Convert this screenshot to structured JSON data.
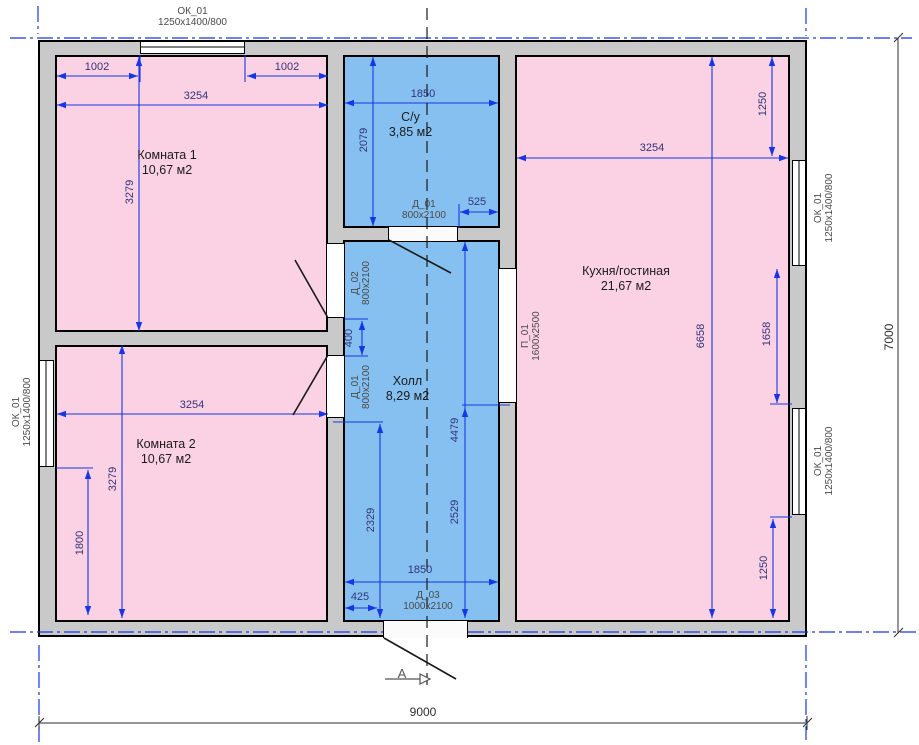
{
  "title": "План этажа",
  "rooms": {
    "room1": {
      "name": "Комната 1",
      "area": "10,67 м2"
    },
    "room2": {
      "name": "Комната 2",
      "area": "10,67 м2"
    },
    "wc": {
      "name": "С/у",
      "area": "3,85 м2"
    },
    "hall": {
      "name": "Холл",
      "area": "8,29 м2"
    },
    "kitchen": {
      "name": "Кухня/гостиная",
      "area": "21,67 м2"
    }
  },
  "openings": {
    "window": {
      "tag": "ОК_01",
      "size": "1250x1400/800"
    },
    "d01": {
      "tag": "Д_01",
      "size": "800x2100"
    },
    "d02": {
      "tag": "Д_02",
      "size": "800x2100"
    },
    "d03": {
      "tag": "Д_03",
      "size": "1000x2100"
    },
    "p01": {
      "tag": "П_01",
      "size": "1600x2500"
    }
  },
  "dims": {
    "room1_seg_left": "1002",
    "room1_seg_right": "1002",
    "room1_width": "3254",
    "room1_height": "3279",
    "wc_width": "1850",
    "wc_height": "2079",
    "wc_door_offset": "525",
    "hall_pier": "400",
    "hall_lower_left": "2329",
    "hall_right_upper": "4479",
    "hall_right_lower": "2529",
    "hall_width": "1850",
    "hall_door_offset": "425",
    "kitchen_width": "3254",
    "kitchen_win_top": "1250",
    "kitchen_height": "6658",
    "kitchen_win_mid": "1658",
    "kitchen_win_bottom": "1250",
    "room2_width": "3254",
    "room2_height": "3279",
    "room2_win_offset": "1800",
    "overall_width": "9000",
    "overall_height": "7000"
  },
  "section": {
    "label": "А"
  },
  "colors": {
    "room_pink": "#fad2e3",
    "room_blue": "#85c0f0",
    "wall_gray": "#c9c9c9",
    "dim_line_blue": "#1636e8",
    "dim_text_navy": "#33337a",
    "axis_blue": "#1636e8"
  }
}
